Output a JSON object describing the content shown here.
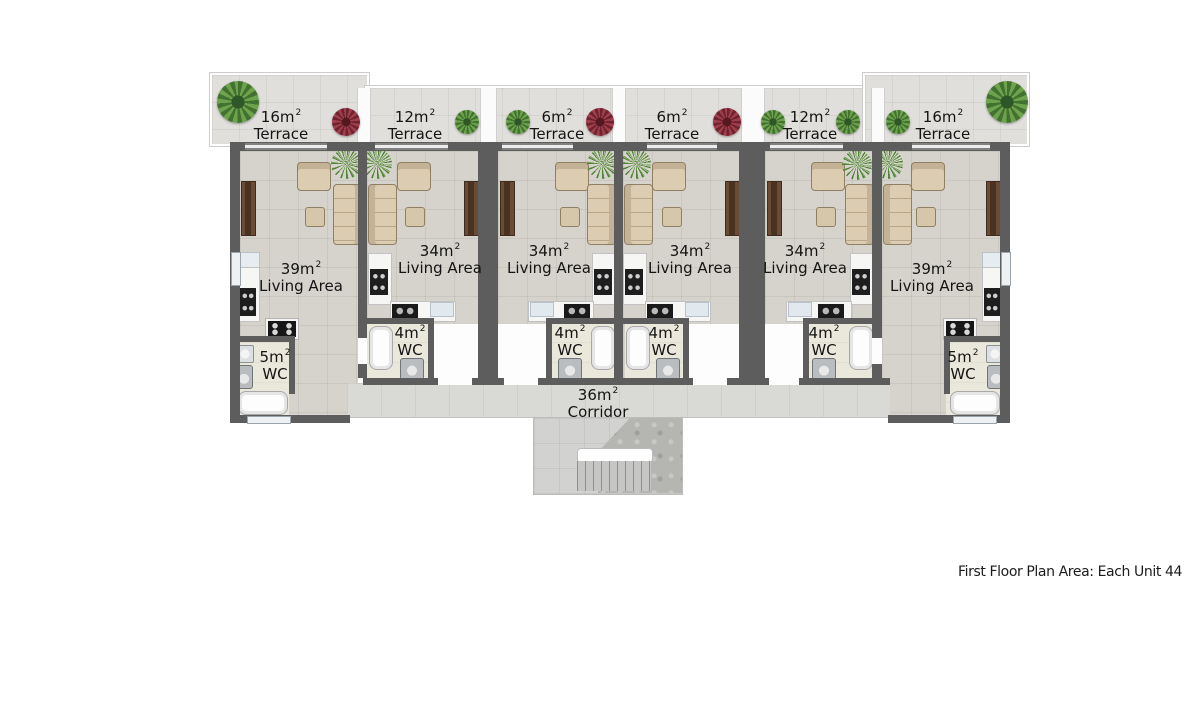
{
  "caption": "First Floor Plan Area: Each Unit 44",
  "terraces": [
    {
      "size": "16m",
      "sup": "2",
      "label": "Terrace"
    },
    {
      "size": "12m",
      "sup": "2",
      "label": "Terrace"
    },
    {
      "size": "6m",
      "sup": "2",
      "label": "Terrace"
    },
    {
      "size": "6m",
      "sup": "2",
      "label": "Terrace"
    },
    {
      "size": "12m",
      "sup": "2",
      "label": "Terrace"
    },
    {
      "size": "16m",
      "sup": "2",
      "label": "Terrace"
    }
  ],
  "living_areas": [
    {
      "size": "39m",
      "sup": "2",
      "label": "Living Area"
    },
    {
      "size": "34m",
      "sup": "2",
      "label": "Living Area"
    },
    {
      "size": "34m",
      "sup": "2",
      "label": "Living Area"
    },
    {
      "size": "34m",
      "sup": "2",
      "label": "Living Area"
    },
    {
      "size": "34m",
      "sup": "2",
      "label": "Living Area"
    },
    {
      "size": "39m",
      "sup": "2",
      "label": "Living Area"
    }
  ],
  "wcs": [
    {
      "size": "5m",
      "sup": "2",
      "label": "WC"
    },
    {
      "size": "4m",
      "sup": "2",
      "label": "WC"
    },
    {
      "size": "4m",
      "sup": "2",
      "label": "WC"
    },
    {
      "size": "4m",
      "sup": "2",
      "label": "WC"
    },
    {
      "size": "4m",
      "sup": "2",
      "label": "WC"
    },
    {
      "size": "5m",
      "sup": "2",
      "label": "WC"
    }
  ],
  "corridor": {
    "size": "36m",
    "sup": "2",
    "label": "Corridor"
  },
  "colors": {
    "wall": "#5d5d5d",
    "living_floor": "#d6d3cc",
    "terrace_floor": "#e0dfdc",
    "wc_floor": "#eae7db",
    "corridor_floor": "#d9d9d6",
    "furniture_beige": "#dccdb2",
    "tv_cabinet_brown": "#6a4c36",
    "plant_green": "#437230",
    "plant_red": "#6f2230",
    "label_text": "#141414"
  }
}
